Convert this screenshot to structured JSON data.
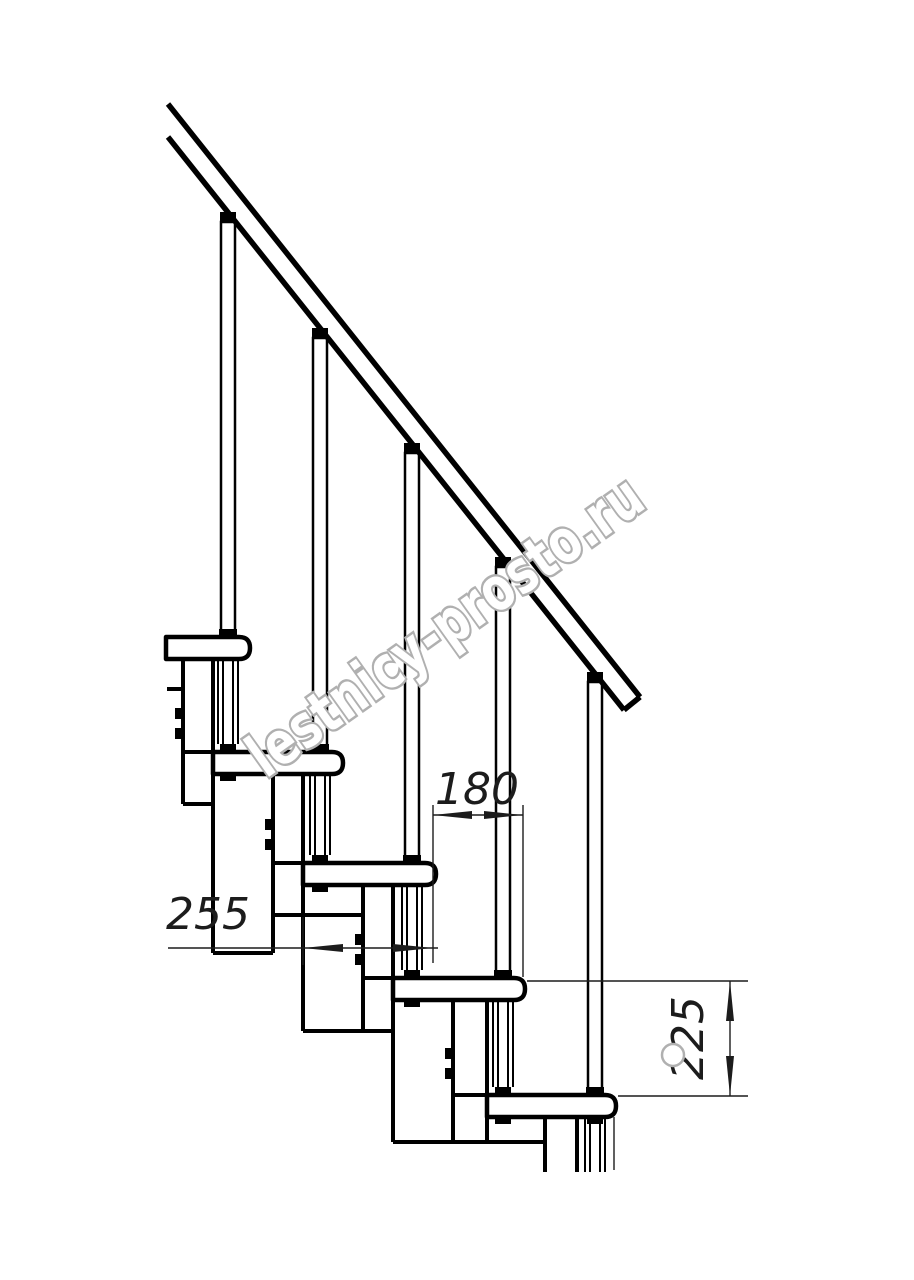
{
  "drawing": {
    "watermark": "lestnicy-prosto.ru",
    "dimensions": {
      "step_run": "180",
      "tread_depth": "255",
      "step_rise": "225"
    }
  },
  "colors": {
    "line": "#000000",
    "dim_text": "#1c1c1c",
    "watermark_outline": "#b0b0b0",
    "background": "#ffffff"
  }
}
